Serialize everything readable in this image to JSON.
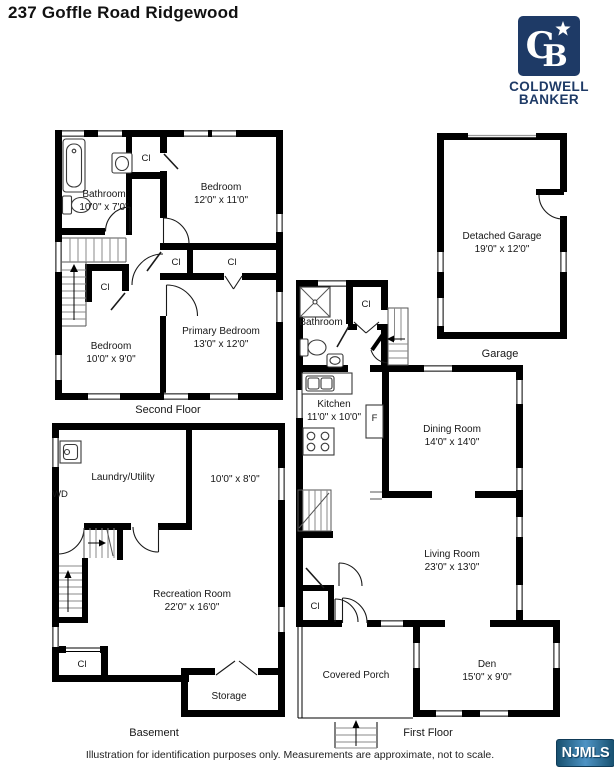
{
  "page_title": "237 Goffle Road Ridgewood",
  "brand": {
    "monogram_c": "C",
    "monogram_b": "B",
    "name_line1": "COLDWELL",
    "name_line2": "BANKER",
    "navy": "#1E3A66"
  },
  "labels": {
    "closet": "Cl",
    "fridge": "F",
    "washer_dryer": "WD"
  },
  "floors": {
    "second_floor": {
      "caption": "Second Floor",
      "bathroom": {
        "name": "Bathroom",
        "dims": "10'0\" x 7'0\""
      },
      "bedroom_front": {
        "name": "Bedroom",
        "dims": "12'0\" x 11'0\""
      },
      "primary_bedroom": {
        "name": "Primary Bedroom",
        "dims": "13'0\" x 12'0\""
      },
      "bedroom_rear": {
        "name": "Bedroom",
        "dims": "10'0\" x 9'0\""
      }
    },
    "garage": {
      "caption": "Garage",
      "detached_garage": {
        "name": "Detached Garage",
        "dims": "19'0\" x 12'0\""
      }
    },
    "first_floor": {
      "caption": "First Floor",
      "bathroom": {
        "name": "Bathroom"
      },
      "kitchen": {
        "name": "Kitchen",
        "dims": "11'0\" x 10'0\""
      },
      "dining_room": {
        "name": "Dining Room",
        "dims": "14'0\" x 14'0\""
      },
      "living_room": {
        "name": "Living Room",
        "dims": "23'0\" x 13'0\""
      },
      "den": {
        "name": "Den",
        "dims": "15'0\" x 9'0\""
      },
      "covered_porch": {
        "name": "Covered Porch"
      }
    },
    "basement": {
      "caption": "Basement",
      "laundry_utility": {
        "name": "Laundry/Utility"
      },
      "bonus_room": {
        "dims": "10'0\" x 8'0\""
      },
      "recreation_room": {
        "name": "Recreation Room",
        "dims": "22'0\" x 16'0\""
      },
      "storage": {
        "name": "Storage"
      }
    }
  },
  "footer": {
    "disclaimer": "Illustration for identification purposes only. Measurements are approximate, not to scale.",
    "mls": "NJMLS"
  }
}
